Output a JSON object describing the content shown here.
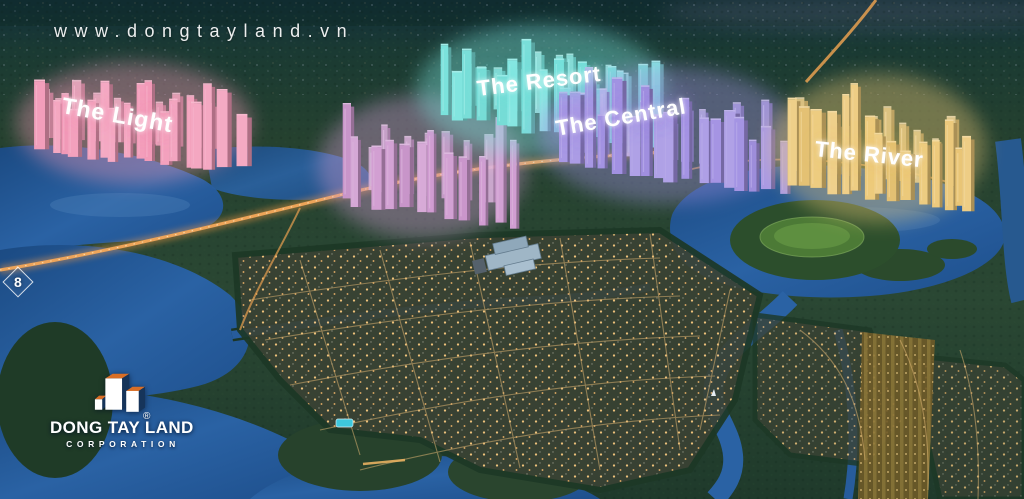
{
  "watermark": {
    "url_text": "www.dongtayland.vn"
  },
  "page_marker": {
    "number": "8"
  },
  "zones": [
    {
      "id": "light",
      "label": "The Light",
      "color": "#f29ab8"
    },
    {
      "id": "resort",
      "label": "The Resort",
      "color": "#7ce4de"
    },
    {
      "id": "central",
      "label": "The Central",
      "color": "#a291e2"
    },
    {
      "id": "river",
      "label": "The River",
      "color": "#ecc878"
    }
  ],
  "logo": {
    "company": "DONG TAY LAND",
    "subtitle": "CORPORATION",
    "registered_mark": "®",
    "brand_colors": {
      "orange": "#d96e26",
      "navy": "#16345a",
      "white": "#ffffff"
    }
  }
}
